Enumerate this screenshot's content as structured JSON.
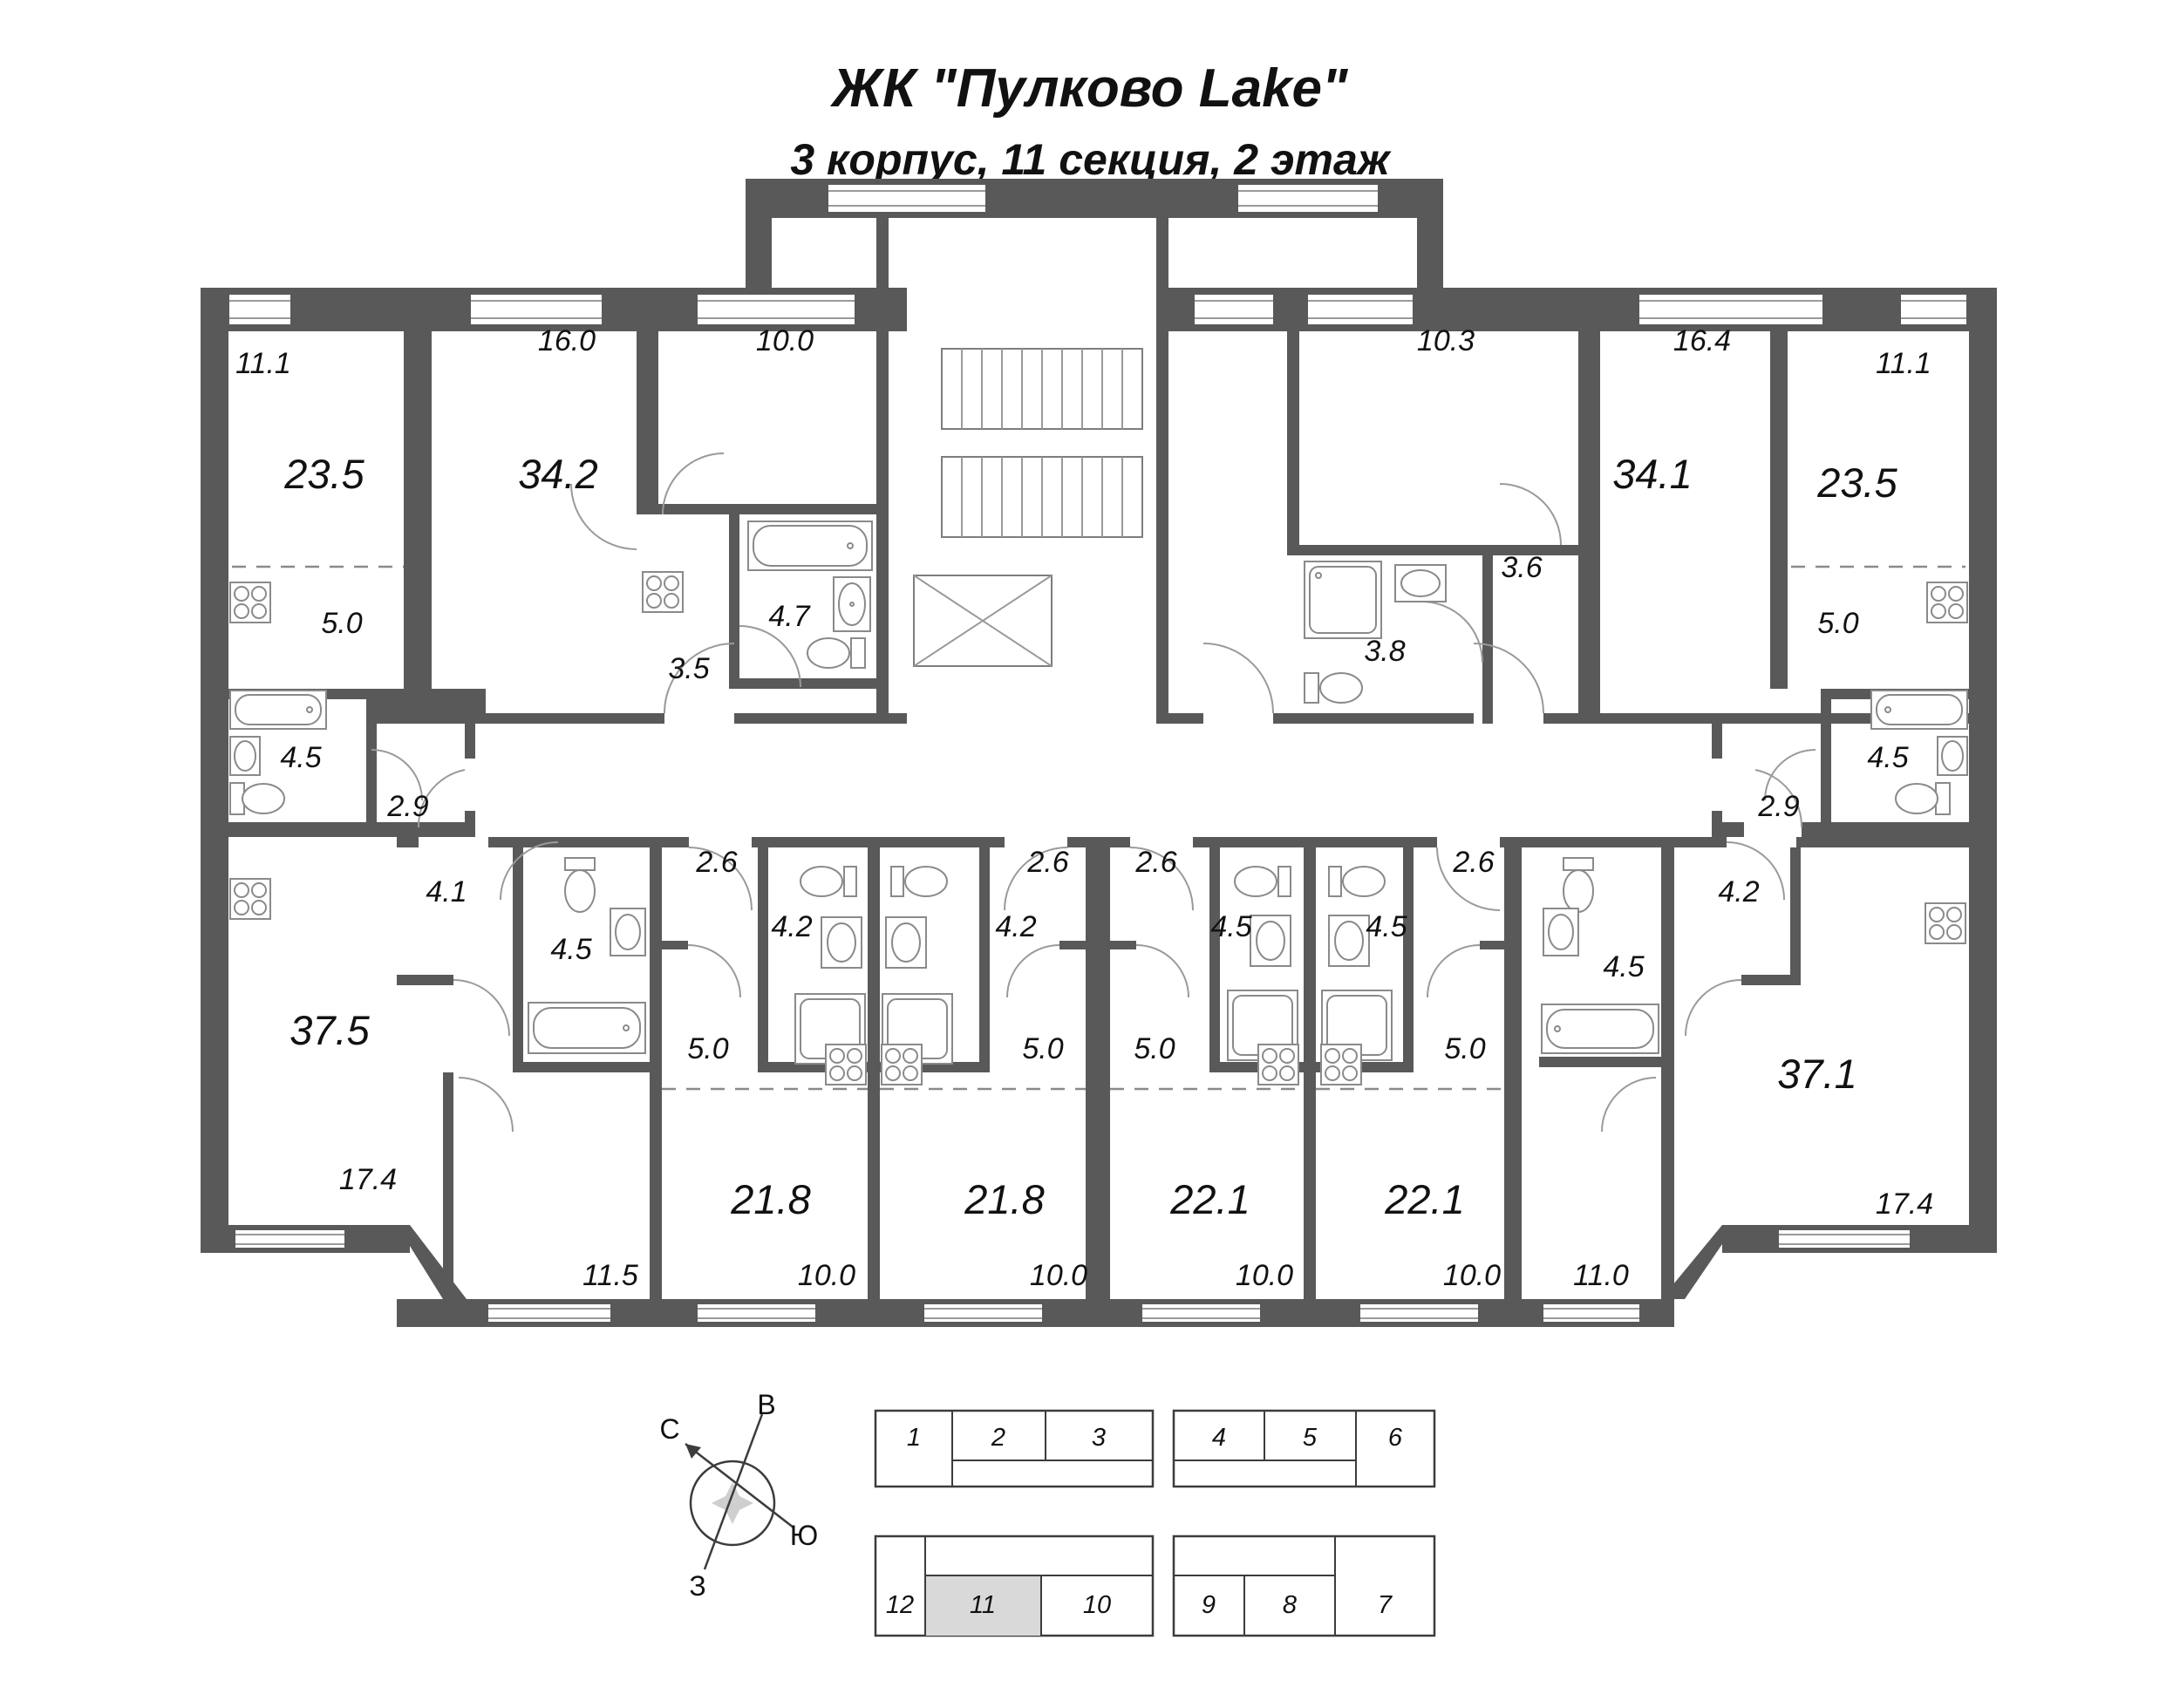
{
  "header": {
    "title": "ЖК \"Пулково Lake\"",
    "subtitle": "3 корпус, 11 секция, 2 этаж"
  },
  "apartments": {
    "left_studio": {
      "total": "23.5",
      "room": "11.1",
      "kitchen": "5.0",
      "bath": "4.5",
      "hall": "2.9"
    },
    "mid_left": {
      "total": "34.2",
      "room1": "16.0",
      "room2": "10.0",
      "bath": "4.7",
      "hall": "3.5"
    },
    "mid_right": {
      "total": "34.1",
      "room1": "16.4",
      "room2": "10.3",
      "bath": "3.8",
      "hall": "3.6"
    },
    "right_studio": {
      "total": "23.5",
      "room": "11.1",
      "kitchen": "5.0",
      "bath": "4.5",
      "hall": "2.9"
    },
    "left_large": {
      "total": "37.5",
      "room1": "17.4",
      "room2": "11.5",
      "bath": "4.5",
      "hall": "4.1"
    },
    "studio_a": {
      "total": "21.8",
      "room": "10.0",
      "kitchen": "5.0",
      "bath": "4.2",
      "hall": "2.6"
    },
    "studio_b": {
      "total": "21.8",
      "room": "10.0",
      "kitchen": "5.0",
      "bath": "4.2",
      "hall": "2.6"
    },
    "studio_c": {
      "total": "22.1",
      "room": "10.0",
      "kitchen": "5.0",
      "bath": "4.5",
      "hall": "2.6"
    },
    "studio_d": {
      "total": "22.1",
      "room": "10.0",
      "kitchen": "5.0",
      "bath": "4.5",
      "hall": "2.6"
    },
    "right_large": {
      "total": "37.1",
      "room1": "17.4",
      "room2": "11.0",
      "bath": "4.5",
      "hall": "4.2"
    }
  },
  "compass": {
    "north": "С",
    "east": "В",
    "south": "Ю",
    "west": "З"
  },
  "key_plan": {
    "sections": [
      "1",
      "2",
      "3",
      "4",
      "5",
      "6",
      "7",
      "8",
      "9",
      "10",
      "11",
      "12"
    ],
    "highlighted": "11"
  }
}
